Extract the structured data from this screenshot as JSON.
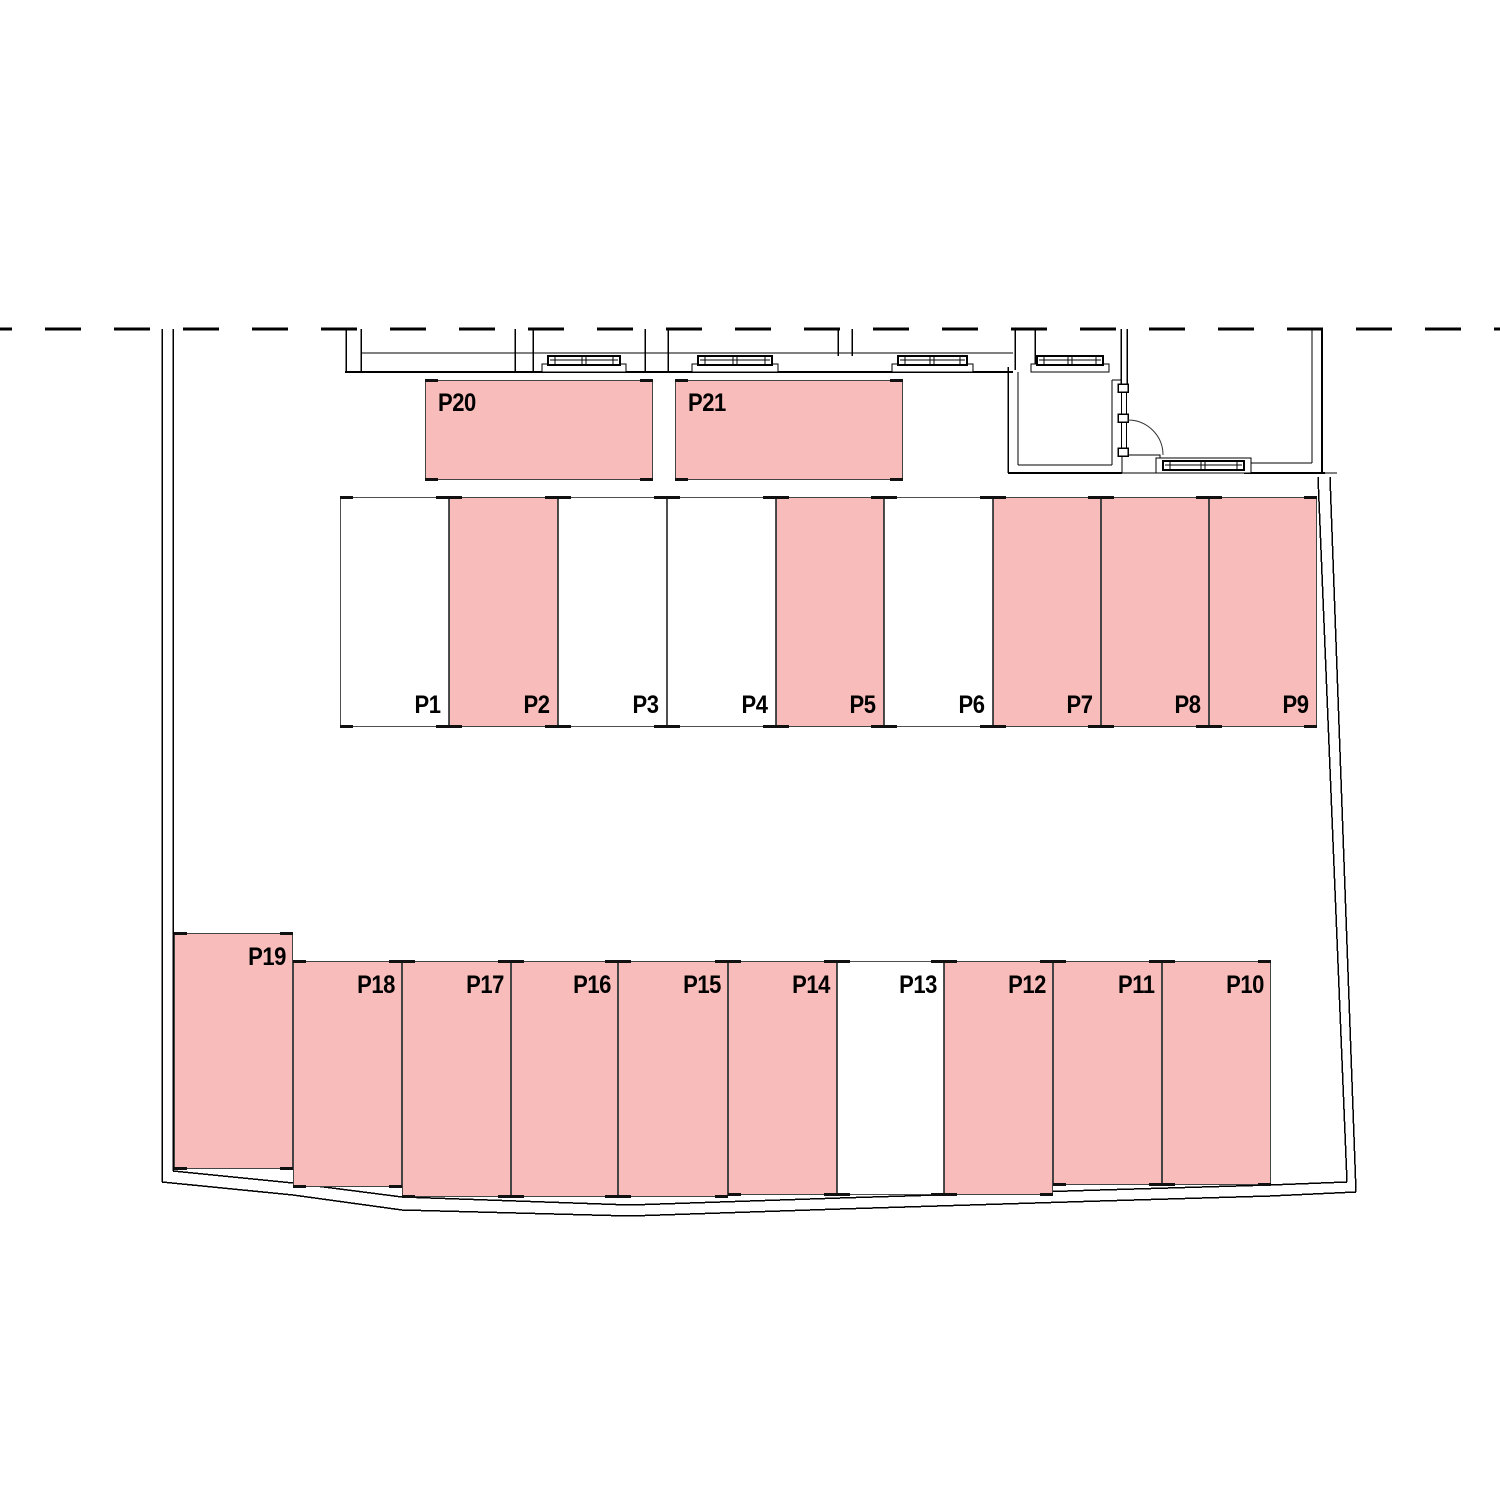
{
  "plan": {
    "name": "parking-layout-plan",
    "colors": {
      "occupied_fill": "#f8bcba",
      "free_fill": "#ffffff",
      "stall_border": "#4f4f4f",
      "line": "#000000"
    },
    "stalls": [
      {
        "id": "P20",
        "label": "P20",
        "x": 425,
        "y": 380,
        "w": 228,
        "h": 100,
        "occupied": true,
        "label_pos": "top-left"
      },
      {
        "id": "P21",
        "label": "P21",
        "x": 675,
        "y": 380,
        "w": 228,
        "h": 100,
        "occupied": true,
        "label_pos": "top-left"
      },
      {
        "id": "P1",
        "label": "P1",
        "x": 340,
        "y": 497,
        "w": 109,
        "h": 230,
        "occupied": false,
        "label_pos": "bottom-right"
      },
      {
        "id": "P2",
        "label": "P2",
        "x": 449,
        "y": 497,
        "w": 109,
        "h": 230,
        "occupied": true,
        "label_pos": "bottom-right"
      },
      {
        "id": "P3",
        "label": "P3",
        "x": 558,
        "y": 497,
        "w": 109,
        "h": 230,
        "occupied": false,
        "label_pos": "bottom-right"
      },
      {
        "id": "P4",
        "label": "P4",
        "x": 667,
        "y": 497,
        "w": 109,
        "h": 230,
        "occupied": false,
        "label_pos": "bottom-right"
      },
      {
        "id": "P5",
        "label": "P5",
        "x": 776,
        "y": 497,
        "w": 108,
        "h": 230,
        "occupied": true,
        "label_pos": "bottom-right"
      },
      {
        "id": "P6",
        "label": "P6",
        "x": 884,
        "y": 497,
        "w": 109,
        "h": 230,
        "occupied": false,
        "label_pos": "bottom-right"
      },
      {
        "id": "P7",
        "label": "P7",
        "x": 993,
        "y": 497,
        "w": 108,
        "h": 230,
        "occupied": true,
        "label_pos": "bottom-right"
      },
      {
        "id": "P8",
        "label": "P8",
        "x": 1101,
        "y": 497,
        "w": 108,
        "h": 230,
        "occupied": true,
        "label_pos": "bottom-right"
      },
      {
        "id": "P9",
        "label": "P9",
        "x": 1209,
        "y": 497,
        "w": 108,
        "h": 230,
        "occupied": true,
        "label_pos": "bottom-right"
      },
      {
        "id": "P19",
        "label": "P19",
        "x": 174,
        "y": 933,
        "w": 119,
        "h": 236,
        "occupied": true,
        "label_pos": "top-right"
      },
      {
        "id": "P18",
        "label": "P18",
        "x": 293,
        "y": 961,
        "w": 109,
        "h": 226,
        "occupied": true,
        "label_pos": "top-right"
      },
      {
        "id": "P17",
        "label": "P17",
        "x": 402,
        "y": 961,
        "w": 109,
        "h": 236,
        "occupied": true,
        "label_pos": "top-right"
      },
      {
        "id": "P16",
        "label": "P16",
        "x": 511,
        "y": 961,
        "w": 107,
        "h": 236,
        "occupied": true,
        "label_pos": "top-right"
      },
      {
        "id": "P15",
        "label": "P15",
        "x": 618,
        "y": 961,
        "w": 110,
        "h": 236,
        "occupied": true,
        "label_pos": "top-right"
      },
      {
        "id": "P14",
        "label": "P14",
        "x": 728,
        "y": 961,
        "w": 109,
        "h": 234,
        "occupied": true,
        "label_pos": "top-right"
      },
      {
        "id": "P13",
        "label": "P13",
        "x": 837,
        "y": 961,
        "w": 107,
        "h": 234,
        "occupied": false,
        "label_pos": "top-right"
      },
      {
        "id": "P12",
        "label": "P12",
        "x": 944,
        "y": 961,
        "w": 109,
        "h": 234,
        "occupied": true,
        "label_pos": "top-right"
      },
      {
        "id": "P11",
        "label": "P11",
        "x": 1053,
        "y": 961,
        "w": 109,
        "h": 224,
        "occupied": true,
        "label_pos": "top-right"
      },
      {
        "id": "P10",
        "label": "P10",
        "x": 1162,
        "y": 961,
        "w": 109,
        "h": 224,
        "occupied": true,
        "label_pos": "top-right"
      }
    ]
  }
}
